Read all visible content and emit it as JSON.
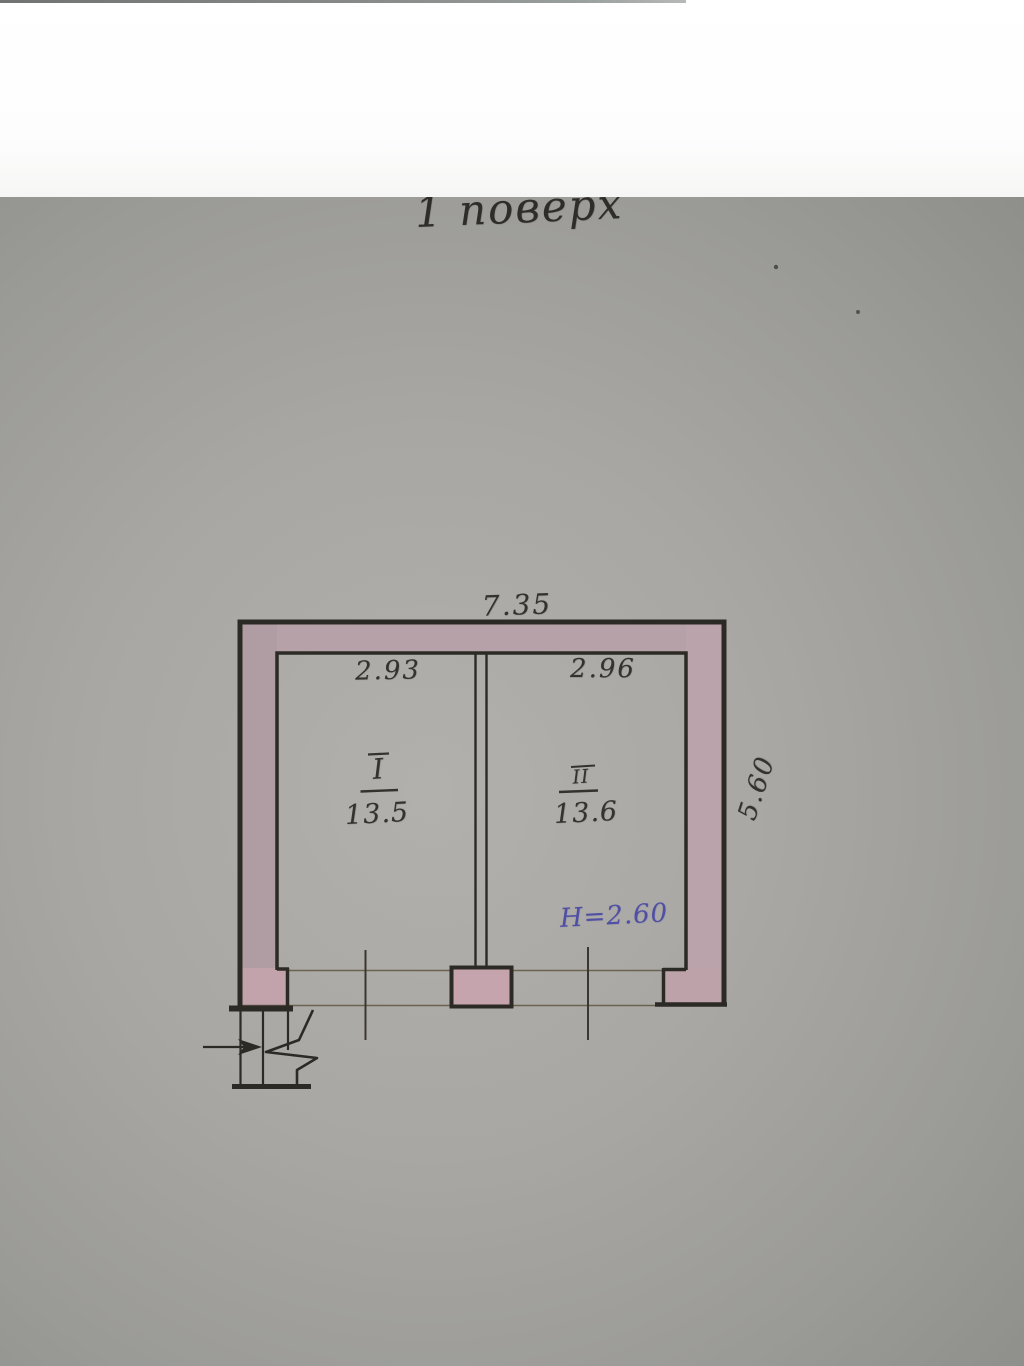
{
  "photo": {
    "title": "1 поверх",
    "dimensions": {
      "overall_width": "7.35",
      "room1_width": "2.93",
      "room2_width": "2.96",
      "overall_depth": "5.60",
      "height_note": "Н=2.60"
    },
    "rooms": [
      {
        "numeral": "I",
        "area": "13.5"
      },
      {
        "numeral": "II",
        "area": "13.6"
      }
    ],
    "colors": {
      "wall_fill_pink": "#b5a1a8",
      "drawing_line": "#2c2a25",
      "pencil_ink": "#34322d",
      "height_ink_blue": "#4f4fa4",
      "paper_gray": "#9a9a96",
      "white_band": "#fcfcfc"
    }
  }
}
